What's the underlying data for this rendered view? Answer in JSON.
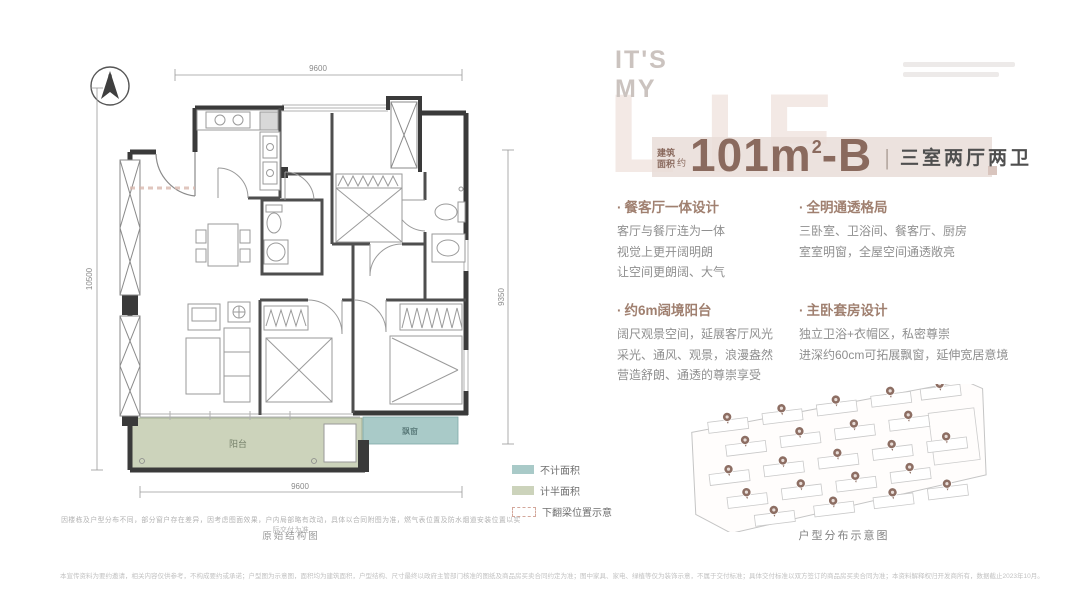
{
  "brand": {
    "line1": "IT'S",
    "line2": "MY",
    "big_letters": "LIF"
  },
  "title": {
    "area_label_top": "建筑",
    "area_label_bottom": "面积",
    "approx": "约",
    "number": "101m",
    "sup": "2",
    "suffix": "-B",
    "divider": "|",
    "layout": "三室两厅两卫"
  },
  "features": [
    {
      "title": "餐客厅一体设计",
      "lines": [
        "客厅与餐厅连为一体",
        "视觉上更开阔明朗",
        "让空间更朗阔、大气"
      ]
    },
    {
      "title": "全明通透格局",
      "lines": [
        "三卧室、卫浴间、餐客厅、厨房",
        "室室明窗，全屋空间通透敞亮"
      ]
    },
    {
      "title": "约6m阔境阳台",
      "lines": [
        "阔尺观景空间，延展客厅风光",
        "采光、通风、观景，浪漫盎然",
        "营造舒朗、通透的尊崇享受"
      ]
    },
    {
      "title": "主卧套房设计",
      "lines": [
        "独立卫浴+衣帽区，私密尊崇",
        "进深约60cm可拓展飘窗，延伸宽居意境"
      ]
    }
  ],
  "plan": {
    "north": "N",
    "dim_top": "9600",
    "dim_left": "10500",
    "dim_right": "9350",
    "dim_bottom": "9600",
    "balcony_label": "阳台",
    "bay_window_label": "飘窗",
    "note_line1": "因楼栋及户型分布不同，部分窗户存在差异，因考虑图面效果，户内局部略有改动，具体以合同附图为准，燃气表位置及防水烟道安装位置以实际交付为准",
    "note_line2": "原始结构图"
  },
  "legend": [
    {
      "label": "不计面积",
      "color": "#a9cac8"
    },
    {
      "label": "计半面积",
      "color": "#ccd3bb"
    },
    {
      "label": "下翻梁位置示意",
      "color": "dashed"
    }
  ],
  "siteplan": {
    "caption": "户型分布示意图"
  },
  "footer": {
    "disclaimer": "本宣传资料为要约邀请，相关内容仅供参考，不构成要约或承诺；户型图为示意图，面积均为建筑面积，户型结构、尺寸最终以政府主管部门核准的图纸及商品房买卖合同约定为准；图中家具、家电、绿植等仅为装饰示意，不属于交付标准；具体交付标准以双方签订的商品房买卖合同为准；本资料解释权归开发商所有，数据截止2023年10月。"
  },
  "colors": {
    "accent_brown": "#8a6a5e",
    "feature_title": "#a08070",
    "title_band": "#e9ddd8",
    "big_letters": "#f3e9e5",
    "balcony_fill": "#ccd3bb",
    "bay_window_fill": "#a9cac8",
    "pin": "#8d6e63",
    "wall": "#3a3a3a"
  }
}
